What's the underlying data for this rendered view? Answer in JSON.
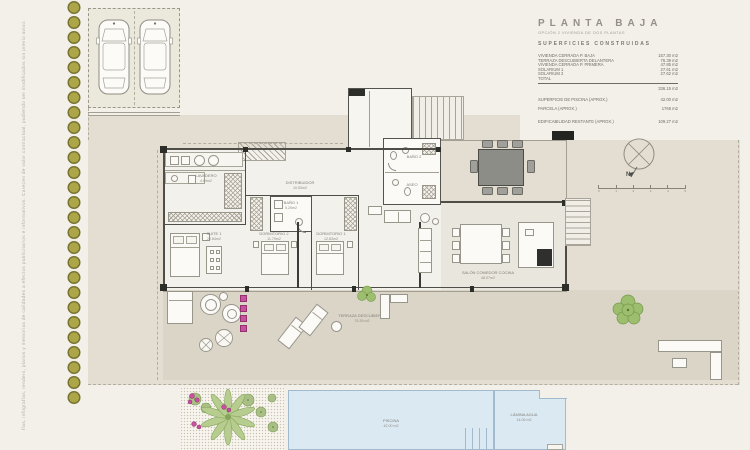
{
  "sheet": {
    "disclaimer": "fías, infografías, renders, planos y memorias de calidades a efectos publicitarios e informativos. Carecen de valor contractual, pudiendo ser modificados sin previo aviso."
  },
  "title_block": {
    "title": "PLANTA BAJA",
    "subtitle": "OPCIÓN 2 VIVIENDA DE DOS PLANTAS",
    "section": "SUPERFICIES CONSTRUIDAS",
    "rows": [
      {
        "label": "VIVIENDA CERRADA P. BAJA",
        "value": "157.30 m2"
      },
      {
        "label": "TERRAZA DESCUBIERTA DELANTERA",
        "value": "76.39 m2"
      },
      {
        "label": "VIVIENDA CERRADA P. PRIMERA",
        "value": "47.85 m2"
      },
      {
        "label": "SOLARIUM 1",
        "value": "27.61 m2"
      },
      {
        "label": "SOLARIUM 2",
        "value": "27.62 m2"
      },
      {
        "label": "TOTAL",
        "value": ""
      }
    ],
    "total_value": "336.15 m2",
    "extra_rows": [
      {
        "label": "SUPERFICIE DE PISCINA   (APROX.)",
        "value": "42.00 m2"
      },
      {
        "label": "PARCELA   (APROX.)",
        "value": "1766 m2"
      },
      {
        "label": "EDIFICABILIDAD RESTANTE   (APROX.)",
        "value": "109.27 m2"
      }
    ]
  },
  "compass": {
    "north_label": "N"
  },
  "scale_bar": {
    "ticks": [
      "0",
      "1",
      "2",
      "3",
      "4",
      "5"
    ]
  },
  "rooms": {
    "lavadero": {
      "name": "LAVADERO",
      "area": "4.69m2"
    },
    "distribuidor": {
      "name": "DISTRIBUIDOR",
      "area": "10.53m2"
    },
    "suite1": {
      "name": "SUITE 1",
      "area": "20.84m2"
    },
    "dormitorio2": {
      "name": "DORMITORIO 2",
      "area": "11.79m2"
    },
    "bano1": {
      "name": "BAÑO 1",
      "area": "5.25m2"
    },
    "dormitorio1": {
      "name": "DORMITORIO 1",
      "area": "12.83m2"
    },
    "bano2": {
      "name": "BAÑO 2",
      "area": ""
    },
    "aseo": {
      "name": "ASEO",
      "area": ""
    },
    "salon": {
      "name": "SALÓN COMEDOR COCINA",
      "area": "48.07m2"
    },
    "terraza": {
      "name": "TERRAZA DESCUBIERTA",
      "area": "76.39 m2"
    },
    "piscina": {
      "name": "PISCINA",
      "area": "42.00 m2"
    },
    "lamina": {
      "name": "LÁMINA AGUA",
      "area": "14.06 m2"
    }
  },
  "colors": {
    "sheet": "#f3f0e9",
    "ground": "#e3ded1",
    "terrace": "#dad5c7",
    "pool_water": "#dbe9f3",
    "hedge_olive": "#aca648",
    "flower_pink": "#c7519f",
    "plant_green": "#9dbd6f",
    "wall_dark": "#4f4d48"
  }
}
